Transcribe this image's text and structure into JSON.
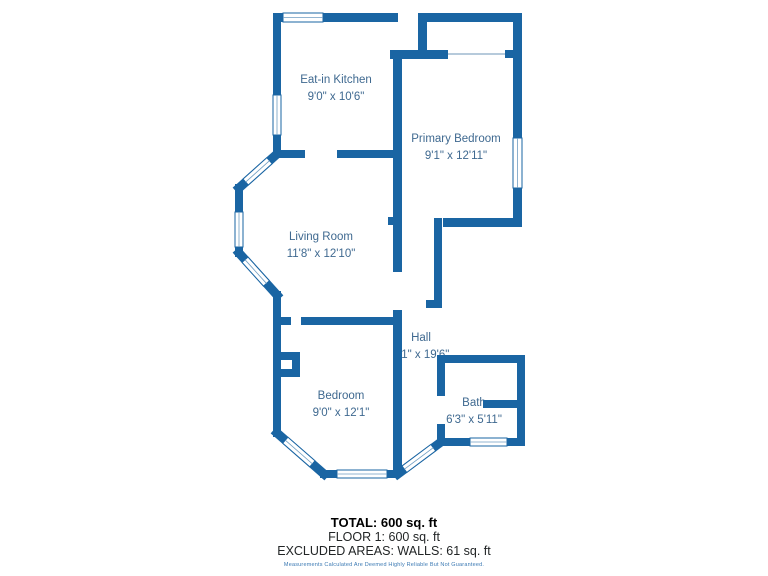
{
  "title": "Floor plan",
  "colors": {
    "wall": "#1a65a3",
    "room_label": "#3f6990",
    "window_fill": "#ffffff",
    "disclaimer": "#3b79b3",
    "background": "#ffffff"
  },
  "rooms": [
    {
      "name": "Eat-in Kitchen",
      "dims": "9'0\" x 10'6\""
    },
    {
      "name": "Primary Bedroom",
      "dims": "9'1\" x 12'11\""
    },
    {
      "name": "Living Room",
      "dims": "11'8\" x 12'10\""
    },
    {
      "name": "Hall",
      "dims": "3'1\" x 19'6\""
    },
    {
      "name": "Bedroom",
      "dims": "9'0\" x 12'1\""
    },
    {
      "name": "Bath",
      "dims": "6'3\" x 5'11\""
    }
  ],
  "footer": {
    "total": "TOTAL: 600 sq. ft",
    "floor": "FLOOR 1: 600 sq. ft",
    "excluded": "EXCLUDED AREAS: WALLS: 61 sq. ft",
    "disclaimer": "Measurements Calculated Are Deemed Highly Reliable But Not Guaranteed."
  }
}
